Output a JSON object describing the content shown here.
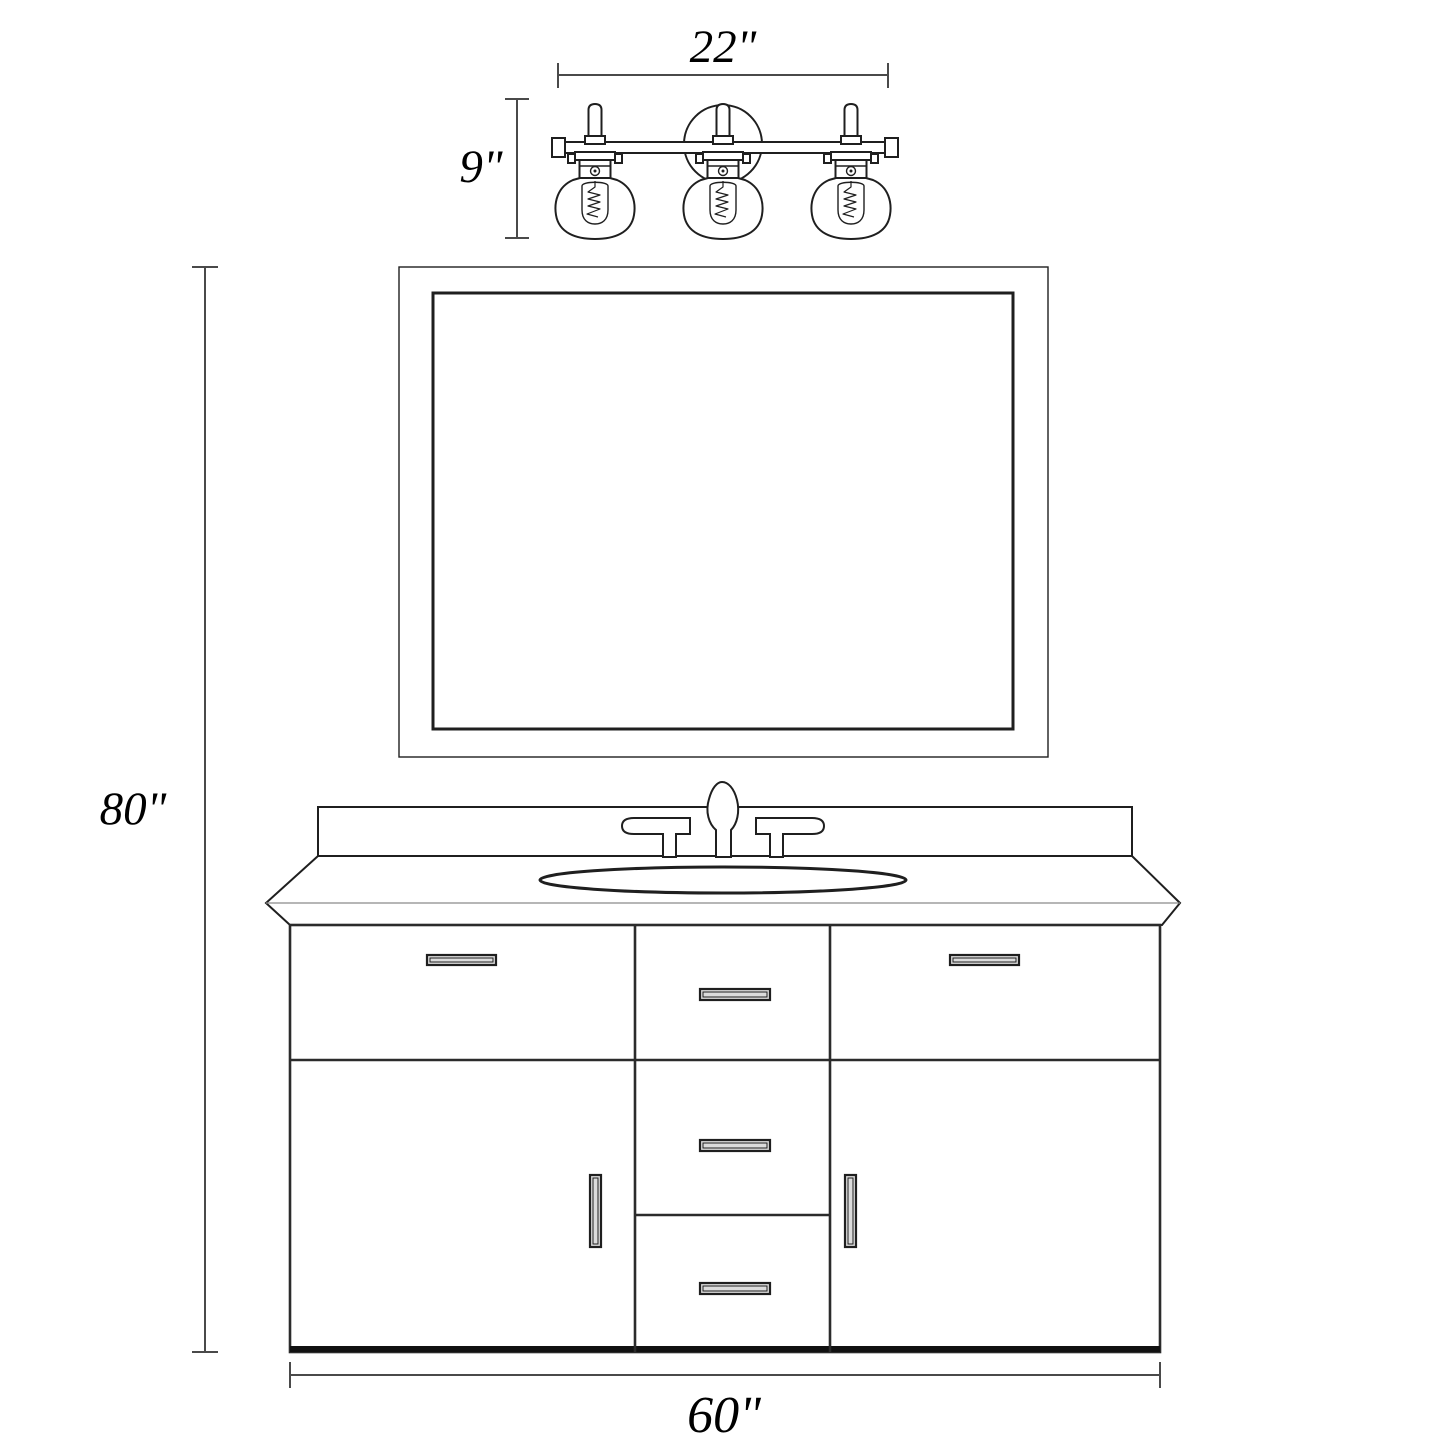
{
  "diagram": {
    "title": "bathroom-vanity-dimension-diagram",
    "dimensions": {
      "light_width": "22\"",
      "light_height": "9\"",
      "total_height": "80\"",
      "vanity_width": "60\""
    },
    "components": [
      "three-light-vanity-fixture",
      "framed-mirror",
      "widespread-faucet",
      "backsplash",
      "countertop-with-oval-sink",
      "vanity-cabinet-two-doors-five-drawers"
    ],
    "colors": {
      "background": "#ffffff",
      "cabinet_fill": "#d2d2d2",
      "handle_fill": "#dcdcdc",
      "outline": "#1f1f1f",
      "dimension_line": "#4a4a4a",
      "cabinet_base": "#111111"
    }
  }
}
